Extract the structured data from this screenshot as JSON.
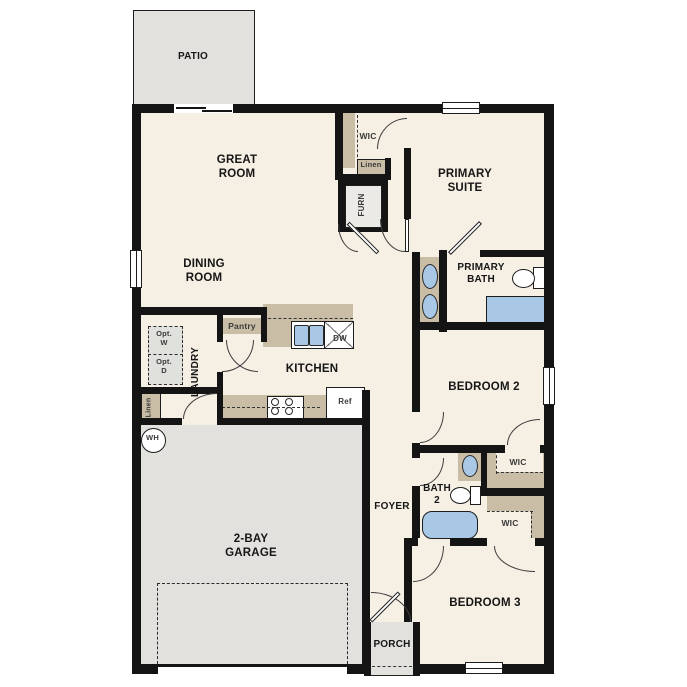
{
  "colors": {
    "wall": "#141414",
    "room": "#f5efe4",
    "casework": "#c9bda6",
    "concrete": "#e2e1de",
    "fixture": "#a9c8e6",
    "optional": "#e0e0dd"
  },
  "labels": {
    "patio": "PATIO",
    "great_room": "GREAT ROOM",
    "dining_room": "DINING ROOM",
    "wic_primary": "WIC",
    "linen_hall": "Linen",
    "furnace": "FURN",
    "primary_suite": "PRIMARY SUITE",
    "primary_bath": "PRIMARY BATH",
    "laundry": "LAUNDRY",
    "opt_washer": "Opt. W",
    "opt_dryer": "Opt. D",
    "pantry": "Pantry",
    "kitchen": "KITCHEN",
    "dishwasher": "DW",
    "refrigerator": "Ref",
    "linen_laundry": "Linen",
    "water_heater": "WH",
    "bedroom2": "BEDROOM 2",
    "bath2": "BATH 2",
    "wic_bedroom2": "WIC",
    "wic_bedroom3": "WIC",
    "foyer": "FOYER",
    "garage": "2-BAY GARAGE",
    "bedroom3": "BEDROOM 3",
    "porch": "PORCH"
  }
}
